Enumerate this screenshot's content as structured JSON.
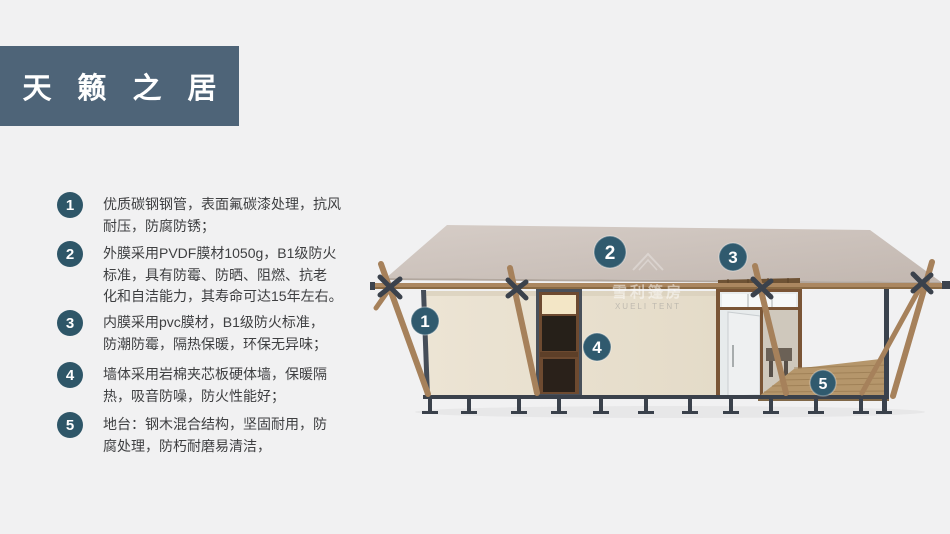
{
  "title": "天籁之居",
  "features": [
    {
      "num": "1",
      "text": "优质碳钢钢管，表面氟碳漆处理，抗风\n耐压，防腐防锈；"
    },
    {
      "num": "2",
      "text": "外膜采用PVDF膜材1050g，B1级防火\n标准，具有防霉、防晒、阻燃、抗老\n化和自洁能力，其寿命可达15年左右。"
    },
    {
      "num": "3",
      "text": "内膜采用pvc膜材，B1级防火标准，\n防潮防霉，隔热保暖，环保无异味；"
    },
    {
      "num": "4",
      "text": "墙体采用岩棉夹芯板硬体墙，保暖隔\n热，吸音防噪，防火性能好；"
    },
    {
      "num": "5",
      "text": "地台：钢木混合结构，坚固耐用，防\n腐处理，防朽耐磨易清洁，"
    }
  ],
  "figure": {
    "badges": [
      {
        "label": "1"
      },
      {
        "label": "2"
      },
      {
        "label": "3"
      },
      {
        "label": "4"
      },
      {
        "label": "5"
      }
    ],
    "watermark": {
      "line1": "雪利篷房",
      "line2": "XUELI TENT"
    }
  },
  "colors": {
    "background": "#f1f1f2",
    "banner": "#4e6478",
    "list_circle": "#2e5668",
    "badge": "#305a6e",
    "roof": "#cdc3bc",
    "wall": "#eae2d1",
    "wood": "#a6815b",
    "metal": "#3a414b",
    "text": "#3e3f41"
  }
}
